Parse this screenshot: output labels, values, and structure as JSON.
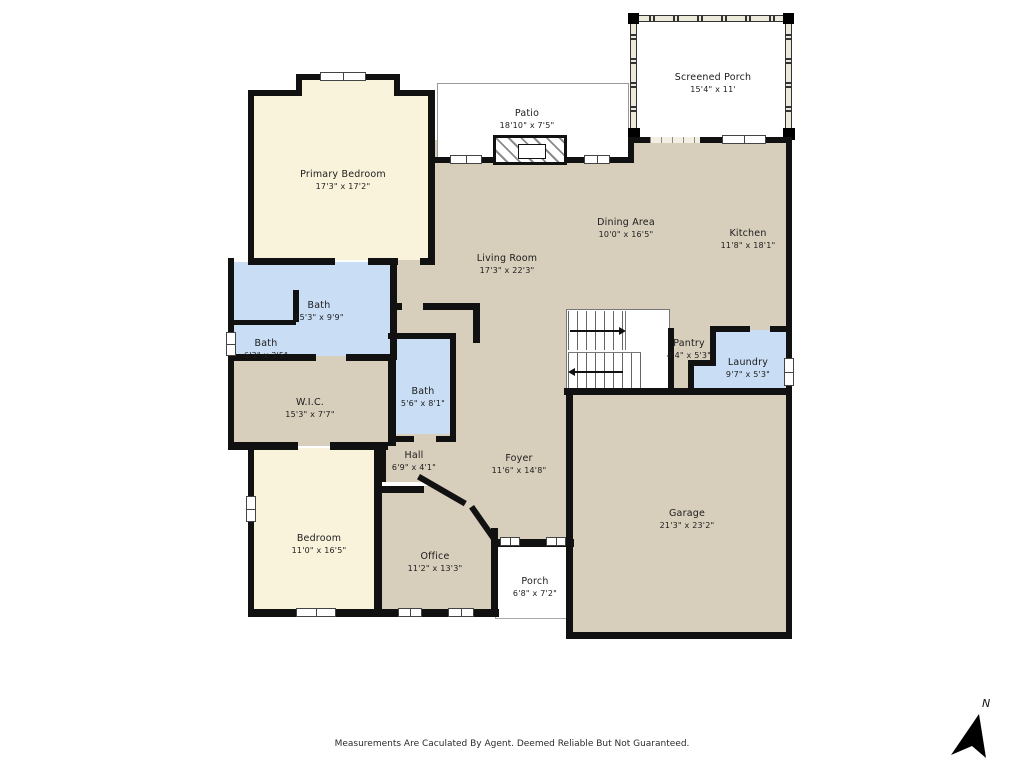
{
  "meta": {
    "title": "Residential Floor Plan"
  },
  "colors": {
    "room_cream": "#FAF3DC",
    "room_blue": "#C9DDF4",
    "room_tan": "#D7CEBC",
    "wall": "#111111",
    "outline_gray": "#999999"
  },
  "rooms": {
    "primary_bedroom": {
      "name": "Primary Bedroom",
      "dims": "17'3\" x 17'2\""
    },
    "patio": {
      "name": "Patio",
      "dims": "18'10\" x 7'5\""
    },
    "screened_porch": {
      "name": "Screened Porch",
      "dims": "15'4\" x 11'"
    },
    "living_room": {
      "name": "Living Room",
      "dims": "17'3\" x 22'3\""
    },
    "dining_area": {
      "name": "Dining Area",
      "dims": "10'0\" x 16'5\""
    },
    "kitchen": {
      "name": "Kitchen",
      "dims": "11'8\" x 18'1\""
    },
    "bath_primary": {
      "name": "Bath",
      "dims": "15'3\" x 9'9\""
    },
    "bath_half": {
      "name": "Bath",
      "dims": "6'3\" x 3'5\""
    },
    "wic": {
      "name": "W.I.C.",
      "dims": "15'3\" x 7'7\""
    },
    "bath_hall": {
      "name": "Bath",
      "dims": "5'6\" x 8'1\""
    },
    "pantry": {
      "name": "Pantry",
      "dims": "4'4\" x 5'3\""
    },
    "laundry": {
      "name": "Laundry",
      "dims": "9'7\" x 5'3\""
    },
    "hall": {
      "name": "Hall",
      "dims": "6'9\" x 4'1\""
    },
    "foyer": {
      "name": "Foyer",
      "dims": "11'6\" x 14'8\""
    },
    "bedroom": {
      "name": "Bedroom",
      "dims": "11'0\" x 16'5\""
    },
    "office": {
      "name": "Office",
      "dims": "11'2\" x 13'3\""
    },
    "porch": {
      "name": "Porch",
      "dims": "6'8\" x 7'2\""
    },
    "garage": {
      "name": "Garage",
      "dims": "21'3\" x 23'2\""
    }
  },
  "footer": {
    "disclaimer": "Measurements Are Caculated By Agent. Deemed Reliable But Not Guaranteed."
  },
  "compass": {
    "label": "N"
  }
}
